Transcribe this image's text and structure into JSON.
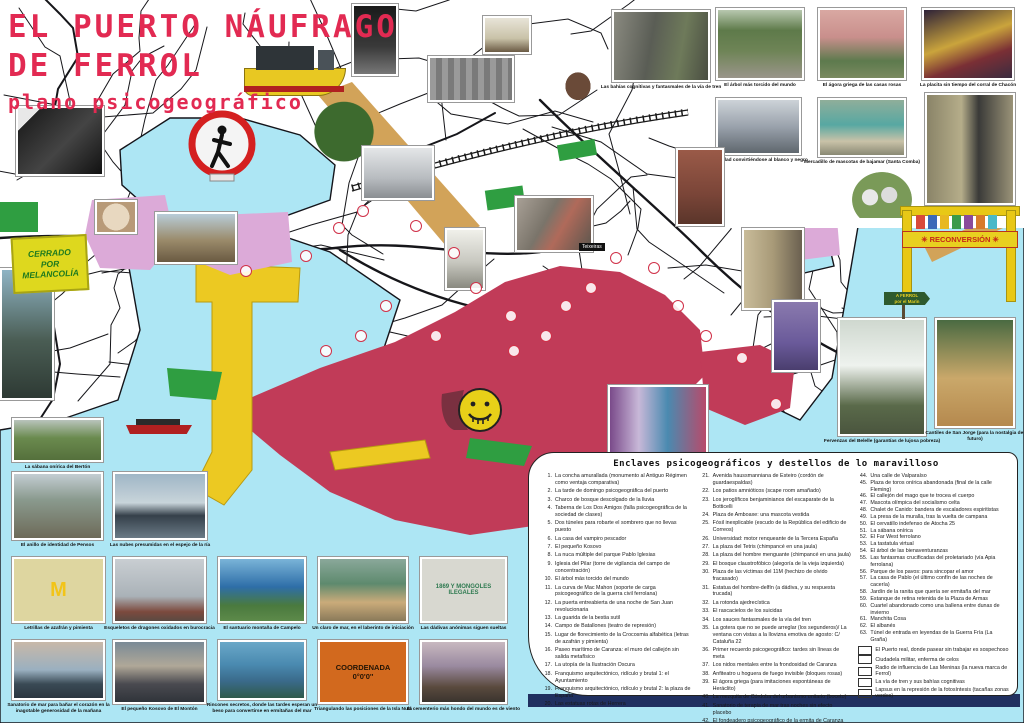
{
  "colors": {
    "water": "#ade6f4",
    "crimson": "#c13b58",
    "port_yellow": "#ecc922",
    "plum": "#dcaad8",
    "rail_tan": "#d2a359",
    "green": "#2f9e41",
    "annotation_red": "#e6254d",
    "title_red": "#e22a52",
    "navy_bar": "#203060"
  },
  "title": {
    "line1": "EL PUERTO NÁUFRAGO",
    "line2": "DE FERROL",
    "subtitle": "plano psicogeográfico"
  },
  "legend": {
    "title": "Enclaves psicogeográficos y destellos de lo maravilloso",
    "col1": [
      {
        "n": "1.",
        "t": "La concha amurallada (monumento al Antiguo Régimen como ventaja comparativa)"
      },
      {
        "n": "2.",
        "t": "La tarde de domingo psicogeográfica del puerto"
      },
      {
        "n": "3.",
        "t": "Charco de bosque descolgado de la lluvia"
      },
      {
        "n": "4.",
        "t": "Taberna de Los Dos Amigos (falla psicogeográfica de la sociedad de clases)"
      },
      {
        "n": "5.",
        "t": "Dos túneles para robarte el sombrero que no llevas puesto"
      },
      {
        "n": "6.",
        "t": "La casa del vampiro pescador"
      },
      {
        "n": "7.",
        "t": "El pequeño Kosovo"
      },
      {
        "n": "8.",
        "t": "La nuca múltiple del parque Pablo Iglesias"
      },
      {
        "n": "9.",
        "t": "Iglesia del Pilar (torre de vigilancia del campo de concentración)"
      },
      {
        "n": "10.",
        "t": "El árbol más torcido del mundo"
      },
      {
        "n": "11.",
        "t": "La curva de Mac Mahon (soporte de carga psicogeográfico de la guerra civil ferrolana)"
      },
      {
        "n": "12.",
        "t": "La puerta entreabierta de una noche de San Juan revolucionaria"
      },
      {
        "n": "13.",
        "t": "La guarida de la bestia sutil"
      },
      {
        "n": "14.",
        "t": "Campo de Batallones (teatro de represión)"
      },
      {
        "n": "15.",
        "t": "Lugar de florecimiento de la Crocosmia alfabética (letras de azafrán y pimienta)"
      },
      {
        "n": "16.",
        "t": "Paseo marítimo de Caranza: el muro del callejón sin salida metafísico"
      },
      {
        "n": "17.",
        "t": "La utopía de la Ilustración Oscura"
      },
      {
        "n": "18.",
        "t": "Franquismo arquitectónico, ridículo y brutal 1: el Ayuntamiento"
      },
      {
        "n": "19.",
        "t": "Franquismo arquitectónico, ridículo y brutal 2: la plaza de España"
      },
      {
        "n": "20.",
        "t": "Las estatuas rotas de Herrera"
      }
    ],
    "col2": [
      {
        "n": "21.",
        "t": "Avenida haussmanniana de Esteiro (cordón de guardaespaldas)"
      },
      {
        "n": "22.",
        "t": "Los patios amnióticos (scape room amañado)"
      },
      {
        "n": "23.",
        "t": "Los jeroglíficos benjaminianos del escaparate de la Botticelli"
      },
      {
        "n": "24.",
        "t": "Plaza de Amboaxe: una mascota vestida"
      },
      {
        "n": "25.",
        "t": "Fósil inexplicable (escudo de la República del edificio de Correos)"
      },
      {
        "n": "26.",
        "t": "Universidad: motor renqueante de la Tercera España"
      },
      {
        "n": "27.",
        "t": "La plaza del Tetris (chimpancé en una jaula)"
      },
      {
        "n": "28.",
        "t": "La plaza del hombre menguante (chimpancé en una jaula)"
      },
      {
        "n": "29.",
        "t": "El bosque claustrofóbico (alegoría de la vieja izquierda)"
      },
      {
        "n": "30.",
        "t": "Plaza de las víctimas del 11M (hechizo de olvido fracasado)"
      },
      {
        "n": "31.",
        "t": "Estatua del hombre-delfín (a dádiva, y su respuesta trucada)"
      },
      {
        "n": "32.",
        "t": "La rotonda ajedrecística"
      },
      {
        "n": "33.",
        "t": "El rascacielos de los suicidas"
      },
      {
        "n": "34.",
        "t": "Los sauces fantasmales de la vía del tren"
      },
      {
        "n": "35.",
        "t": "La gotera que no se puede arreglar (los segunderos)/ La ventana con vistas a la llovizna emotiva de agosto: C/ Cataluña 22"
      },
      {
        "n": "36.",
        "t": "Primer recuerdo psicogeográfico: tardes sin líneas de meta"
      },
      {
        "n": "37.",
        "t": "Los nidos mentales entre la frondosidad de Caranza"
      },
      {
        "n": "38.",
        "t": "Anfiteatro u hoguera de fuego invisible (bloques rosas)"
      },
      {
        "n": "39.",
        "t": "El ágora griega (para imitaciones espontáneas de Heráclito)"
      },
      {
        "n": "40.",
        "t": "La mezquita de Córdoba del urbanismo unitario (boceto)"
      },
      {
        "n": "41.",
        "t": "Sanatorio de terapia de mar tras noches sin efecto placebo"
      },
      {
        "n": "42.",
        "t": "El fondeadero psicogeográfico de la ermita de Caranza"
      },
      {
        "n": "43.",
        "t": "Edificios abstinentes importados de Argel"
      }
    ],
    "col3": [
      {
        "n": "44.",
        "t": "Una calle de Valparaíso"
      },
      {
        "n": "45.",
        "t": "Plaza de toros onírica abandonada (final de la calle Fleming)"
      },
      {
        "n": "46.",
        "t": "El callejón del mago que te trocea el cuerpo"
      },
      {
        "n": "47.",
        "t": "Mascota olímpica del socialismo celta"
      },
      {
        "n": "48.",
        "t": "Chalet de Canido: bandera de escaladores espiritistas"
      },
      {
        "n": "49.",
        "t": "La presa de la muralla, tras la vuelta de campana"
      },
      {
        "n": "50.",
        "t": "El cervatillo indefenso de Atocha 25"
      },
      {
        "n": "51.",
        "t": "La sábana onírica"
      },
      {
        "n": "52.",
        "t": "El Far West ferrolano"
      },
      {
        "n": "53.",
        "t": "La tastatula virtual"
      },
      {
        "n": "54.",
        "t": "El árbol de las bienaventuranzas"
      },
      {
        "n": "55.",
        "t": "Las fantasmas crucificadas del proletariado (vía Apia ferrolana)"
      },
      {
        "n": "56.",
        "t": "Parque de los pavos: para sincopar el amor"
      },
      {
        "n": "57.",
        "t": "La casa de Pablo (el último confín de las noches de cacería)"
      },
      {
        "n": "58.",
        "t": "Jardín de la ranita que quería ser ermitaña del mar"
      },
      {
        "n": "59.",
        "t": "Estanque de retina retenida de la Plaza de Armas"
      },
      {
        "n": "60.",
        "t": "Cuartel abandonado como una ballena entre dunas de invierno"
      },
      {
        "n": "61.",
        "t": "Manchita Cosa"
      },
      {
        "n": "62.",
        "t": "El albanés"
      },
      {
        "n": "63.",
        "t": "Túnel de entrada en leyendas de la Guerra Fría (La Graña)"
      }
    ],
    "swatches": [
      {
        "color": "#ecc922",
        "label": "El Puerto real, donde pasear sin trabajar es sospechoso"
      },
      {
        "color": "#c13b58",
        "label": "Ciudadela militar, enferma de celos"
      },
      {
        "color": "#dcaad8",
        "label": "Radio de influencia de Las Meninas (la nueva marca de Ferrol)"
      },
      {
        "color": "#d2a359",
        "label": "La vía de tren y sus bahías cognitivas"
      },
      {
        "color": "#2f9e41",
        "label": "Lapsus en la represión de la fotosíntesis (tacañas zonas verdes)"
      }
    ]
  },
  "annotations": [
    {
      "t": "Hacia un mundo rural que nunca llega a serlo (la ciudad porosa)",
      "x": 262,
      "y": 116,
      "rot": -19,
      "fs": 9.5,
      "c": "#e6254d"
    },
    {
      "t": "El patio trasero de la Maláta",
      "x": 176,
      "y": 130,
      "rot": -13,
      "fs": 10,
      "c": "#e6254d"
    },
    {
      "t": "El gueto enxebre de Catabois",
      "x": 500,
      "y": 44,
      "rot": -22,
      "fs": 11,
      "c": "#e6254d"
    },
    {
      "t": "El mal país del ensanche",
      "x": 447,
      "y": 174,
      "rot": -34,
      "fs": 10,
      "c": "#e6254d"
    },
    {
      "t": "La nueva patria sin épica de Ultramar",
      "x": 516,
      "y": 200,
      "rot": -38,
      "fs": 9.5,
      "c": "#e6254d"
    },
    {
      "t": "El Bertón (hemofilia\ninmobiliaria)",
      "x": 598,
      "y": 200,
      "rot": -14,
      "fs": 10,
      "c": "#e6254d"
    },
    {
      "t": "Caranza: isla paradisíaca:\nrepública pirata de Nassau",
      "x": 660,
      "y": 278,
      "rot": -10,
      "fs": 10.5,
      "c": "#e6254d"
    },
    {
      "t": "El Ohio psicogeográfico de Esteiro",
      "x": 408,
      "y": 266,
      "rot": 36,
      "fs": 10,
      "c": "#e6254d"
    },
    {
      "t": "La trama urbanística de la Magdalena",
      "x": 220,
      "y": 312,
      "rot": -18,
      "fs": 9,
      "c": "#e6254d"
    },
    {
      "t": "El Monte\nMinúsculo\ndel Marín",
      "x": 832,
      "y": 288,
      "rot": 0,
      "fs": 6.5,
      "c": "#e6254d"
    },
    {
      "t": "Ecosistemas de ballenas con zanjas",
      "x": 430,
      "y": 96,
      "rot": 0,
      "fs": 6.5,
      "c": "#e6254d"
    },
    {
      "t": "Cornucopias de huertas",
      "x": 548,
      "y": 214,
      "rot": -6,
      "fs": 6,
      "c": "#e6254d"
    },
    {
      "t": "El bajío de juguete\nde Ferrol Viejo",
      "x": 210,
      "y": 360,
      "rot": -38,
      "fs": 6.5,
      "c": "#e6254d"
    },
    {
      "t": "Pantanos efímeros",
      "x": 750,
      "y": 226,
      "rot": -8,
      "fs": 8.5,
      "c": "#222222"
    },
    {
      "t": "El cabo de Buena Esperanza",
      "x": 662,
      "y": 428,
      "rot": 0,
      "fs": 8,
      "c": "#111111"
    },
    {
      "t": "Red de calas clandestinas",
      "x": 642,
      "y": 304,
      "rot": 64,
      "fs": 7.5,
      "c": "#222222"
    },
    {
      "t": "El puerto que\nno es una postal",
      "x": 62,
      "y": 298,
      "rot": 0,
      "fs": 14.5,
      "c": "#111111",
      "lh": 1.35
    },
    {
      "t": "la ciudad militar\nemparedada",
      "x": 287,
      "y": 430,
      "rot": -12,
      "fs": 26,
      "c": "#111111",
      "ls": 2,
      "lh": 1.12,
      "ta": "center"
    },
    {
      "t": "FERROL\nMOLA",
      "x": 442,
      "y": 364,
      "rot": -8,
      "fs": 9,
      "c": "#e0bd14"
    }
  ],
  "markers": [
    {
      "n": "3",
      "x": 333,
      "y": 222
    },
    {
      "n": "30",
      "x": 357,
      "y": 205
    },
    {
      "n": "24",
      "x": 410,
      "y": 220
    },
    {
      "n": "4",
      "x": 448,
      "y": 247
    },
    {
      "n": "9",
      "x": 470,
      "y": 282
    },
    {
      "n": "27",
      "x": 505,
      "y": 310
    },
    {
      "n": "13",
      "x": 540,
      "y": 330
    },
    {
      "n": "26",
      "x": 560,
      "y": 300
    },
    {
      "n": "51",
      "x": 585,
      "y": 282
    },
    {
      "n": "33",
      "x": 610,
      "y": 252
    },
    {
      "n": "41",
      "x": 648,
      "y": 262
    },
    {
      "n": "37",
      "x": 672,
      "y": 300
    },
    {
      "n": "16",
      "x": 700,
      "y": 330
    },
    {
      "n": "42",
      "x": 736,
      "y": 352
    },
    {
      "n": "12",
      "x": 508,
      "y": 345
    },
    {
      "n": "18",
      "x": 430,
      "y": 330
    },
    {
      "n": "19",
      "x": 380,
      "y": 300
    },
    {
      "n": "21",
      "x": 355,
      "y": 330
    },
    {
      "n": "1",
      "x": 320,
      "y": 345
    },
    {
      "n": "58",
      "x": 770,
      "y": 398
    },
    {
      "n": "8",
      "x": 300,
      "y": 250
    },
    {
      "n": "45",
      "x": 240,
      "y": 265
    }
  ],
  "photos": [
    {
      "cap": "El árbol más torcido del mundo",
      "x": 716,
      "y": 8,
      "w": 88,
      "h": 72,
      "bg": "linear-gradient(180deg,#b8c8b0 0%,#5e7a4a 30%,#6e8456 60%,#9a958a 100%)"
    },
    {
      "cap": "El ágora griega de las casas rosas",
      "x": 818,
      "y": 8,
      "w": 88,
      "h": 72,
      "bg": "linear-gradient(180deg,#d9a8a2,#c98f8c 40%,#5d7a4d 75%,#7a8a60)"
    },
    {
      "cap": "La placita sin tiempo del corral de Chacón",
      "x": 922,
      "y": 8,
      "w": 92,
      "h": 72,
      "bg": "linear-gradient(160deg,#2e2238,#caa43c 45%,#7a2f35 70%,#3a2c40)"
    },
    {
      "cap": "La ciudad convirtiéndose al blanco y negro",
      "x": 716,
      "y": 98,
      "w": 85,
      "h": 57,
      "bg": "linear-gradient(180deg,#cdd3d8,#9aa2ac 50%,#5f676e)"
    },
    {
      "cap": "Mercadillo de mascotas de bajamar (Santa Comba)",
      "x": 818,
      "y": 98,
      "w": 88,
      "h": 59,
      "bg": "linear-gradient(180deg,#8fae9a,#57a8a2 45%,#c9c2a8 75%,#8a8a74)"
    },
    {
      "cap": "Los desfiladeros de Caranza",
      "x": 925,
      "y": 93,
      "w": 90,
      "h": 112,
      "bg": "linear-gradient(90deg,#8a8468,#b5ad8a 40%,#3a3a38 60%,#9a9378)"
    },
    {
      "cap": "Las bahías cognitivas y fantasmales de la vía de tren",
      "x": 612,
      "y": 10,
      "w": 98,
      "h": 72,
      "bg": "linear-gradient(100deg,#8a8a80,#5a5d55 40%,#6e7a5a 70%,#4a4e42)"
    },
    {
      "cap": "Fervenzas del Belelle (garantías de lujosa pobreza)",
      "x": 838,
      "y": 318,
      "w": 88,
      "h": 118,
      "bg": "linear-gradient(180deg,#cfd8cf,#eef2ee 40%,#5a6a4a 75%,#4a553e)"
    },
    {
      "cap": "Cantiles de San Jorge (para la nostalgia del futuro)",
      "x": 935,
      "y": 318,
      "w": 80,
      "h": 110,
      "bg": "linear-gradient(180deg,#4a6a42,#caa86a 55%,#b5894e)"
    },
    {
      "cap": "La sábana onírica del Bertón",
      "x": 12,
      "y": 418,
      "w": 91,
      "h": 44,
      "bg": "linear-gradient(180deg,#b9c4bc,#6a8a4e 45%,#55703c)"
    },
    {
      "cap": "El anillo de identidad de Pensos",
      "x": 12,
      "y": 472,
      "w": 91,
      "h": 68,
      "bg": "linear-gradient(180deg,#c3cdd2,#8a9a8e 40%,#6d6a58)"
    },
    {
      "cap": "Las nubes presumidas en el espejo de la ría",
      "x": 113,
      "y": 472,
      "w": 94,
      "h": 68,
      "bg": "linear-gradient(180deg,#9fb6c6,#c8d4da 45%,#35404a 65%,#6a7a86)"
    },
    {
      "cap": "Letrillas de azafrán y pimienta",
      "x": 12,
      "y": 557,
      "w": 93,
      "h": 66,
      "bg": "#ded6a0",
      "txt": "M",
      "txtc": "#f2c418",
      "txtfs": 20
    },
    {
      "cap": "Esqueletos de dragones oxidados en burocracia",
      "x": 113,
      "y": 557,
      "w": 93,
      "h": 66,
      "bg": "linear-gradient(180deg,#c9ced2,#aab2b8 60%,#7c4a3e 85%,#5a4a42)"
    },
    {
      "cap": "El santuario montaña de Campelo",
      "x": 218,
      "y": 557,
      "w": 88,
      "h": 66,
      "bg": "linear-gradient(180deg,#7ab4d8,#2e6ea8 45%,#4a7a3e 75%,#5d8a4a)"
    },
    {
      "cap": "Un claro de mar, en el laberinto de iniciación",
      "x": 318,
      "y": 557,
      "w": 90,
      "h": 66,
      "bg": "linear-gradient(180deg,#8aa89a,#5e8a6e 40%,#caab7a 70%,#8a7a5a)"
    },
    {
      "cap": "Las dádivas anónimas siguen sueltas",
      "x": 420,
      "y": 557,
      "w": 87,
      "h": 66,
      "bg": "#d8d8d0",
      "txt": "1869 Y MONGOLES\nILEGALES",
      "txtc": "#2e7a50",
      "txtfs": 6
    },
    {
      "cap": "Sanatorio de mar para bañar el corazón en la inagotable generosidad de la mañana",
      "x": 12,
      "y": 640,
      "w": 93,
      "h": 60,
      "bg": "linear-gradient(180deg,#c8b8a8,#9ab0c0 50%,#3a4a55 75%,#2a3640)"
    },
    {
      "cap": "El pequeño Kosovo de El Montón",
      "x": 113,
      "y": 640,
      "w": 93,
      "h": 64,
      "bg": "linear-gradient(180deg,#7a8a96,#b0a898 40%,#4a4a50 70%,#30343a)"
    },
    {
      "cap": "Rincones secretos, donde las tardes esperan un beso para convertirse en ermitañas del mar",
      "x": 218,
      "y": 640,
      "w": 88,
      "h": 60,
      "bg": "linear-gradient(180deg,#6aa8c8,#4a8ab0 40%,#3a6a8a 70%,#2e5a4a)"
    },
    {
      "cap": "Triangulando las posiciones de la Isla Nula",
      "x": 318,
      "y": 640,
      "w": 90,
      "h": 64,
      "bg": "#d2691e",
      "txt": "COORDENADA\n0°0'0''",
      "txtc": "#241505",
      "txtfs": 7.5
    },
    {
      "cap": "El cementerio más hondo del mundo es de viento",
      "x": 420,
      "y": 640,
      "w": 87,
      "h": 64,
      "bg": "linear-gradient(180deg,#c8b8c0,#9a8aa0 40%,#5a4a3e 75%,#3a342e)"
    },
    {
      "x": 0,
      "y": 268,
      "w": 54,
      "h": 132,
      "bg": "linear-gradient(180deg,#8fb4c4,#4a5d54 55%,#2e3a34)"
    },
    {
      "x": 16,
      "y": 106,
      "w": 88,
      "h": 70,
      "bg": "linear-gradient(135deg,#e8e8e8 15%,#222 15%,#444 55%,#111)"
    },
    {
      "x": 298,
      "y": 98,
      "w": 92,
      "h": 80,
      "cut": true,
      "bg": "radial-gradient(ellipse at 50% 42%,#3d6a2e 0 45%,rgba(0,0,0,0) 46%)"
    },
    {
      "x": 352,
      "y": 4,
      "w": 46,
      "h": 72,
      "bg": "linear-gradient(180deg,#1a1a1a,#3a3a3a 60%,#777)"
    },
    {
      "x": 428,
      "y": 56,
      "w": 86,
      "h": 46,
      "bg": "repeating-linear-gradient(90deg,#9a9a9a 0 6px,#7a7a7a 6px 12px)"
    },
    {
      "x": 483,
      "y": 16,
      "w": 48,
      "h": 38,
      "bg": "linear-gradient(180deg,#e8e4d8,#c9c2a8 60%,#6a5a44)"
    },
    {
      "x": 362,
      "y": 146,
      "w": 72,
      "h": 54,
      "bg": "linear-gradient(180deg,#e4e6e8,#b8bcc0 60%,#8a8e92)"
    },
    {
      "x": 445,
      "y": 228,
      "w": 40,
      "h": 62,
      "bg": "linear-gradient(180deg,#f0f0ea,#c8c8c0 55%,#8a8a80)"
    },
    {
      "x": 515,
      "y": 196,
      "w": 78,
      "h": 56,
      "bg": "linear-gradient(120deg,#a8a096,#7a746a 40%,#b06a5a 60%,#5a564e)"
    },
    {
      "x": 608,
      "y": 385,
      "w": 100,
      "h": 85,
      "bg": "linear-gradient(90deg,#7a4a8a,#c8b8d8 30%,#4a8ab0 60%,#b84a6a)"
    },
    {
      "x": 676,
      "y": 148,
      "w": 48,
      "h": 78,
      "bg": "linear-gradient(180deg,#9a5a48,#7a4538 60%,#5a352a)"
    },
    {
      "x": 742,
      "y": 228,
      "w": 62,
      "h": 82,
      "bg": "linear-gradient(90deg,#c9bc9a,#a89a78 50%,#6a6050)"
    },
    {
      "x": 772,
      "y": 300,
      "w": 48,
      "h": 72,
      "bg": "linear-gradient(180deg,#8a7aae,#6a5a9a 60%,#4a3e6e)"
    },
    {
      "x": 852,
      "y": 172,
      "w": 60,
      "h": 46,
      "cut": true,
      "bg": "radial-gradient(circle at 30% 55%,#e8e8e8 0 16%,rgba(0,0,0,0) 17%),radial-gradient(circle at 62% 50%,#dcdcdc 0 18%,rgba(0,0,0,0) 19%),radial-gradient(ellipse at 50% 60%,#7a9a58 0 70%,rgba(0,0,0,0) 71%)"
    },
    {
      "x": 556,
      "y": 62,
      "w": 44,
      "h": 44,
      "cut": true,
      "bg": "radial-gradient(ellipse at 50% 55%,#6a4a38 0 40%,rgba(0,0,0,0) 41%)"
    },
    {
      "x": 155,
      "y": 212,
      "w": 82,
      "h": 52,
      "bg": "linear-gradient(180deg,#b8ccd8,#9a8a6a 55%,#6a5a42)"
    },
    {
      "x": 95,
      "y": 200,
      "w": 42,
      "h": 34,
      "bg": "radial-gradient(circle at 50% 50%,#e8d8c0 0 55%,#b89a78 56%)"
    }
  ],
  "signs": {
    "cerrado": "CERRADO\nPOR\nMELANCOLÍA",
    "reconversion": "✳ RECONVERSIÓN ✳",
    "teixeiras": "Teixeiras",
    "signpost_l1": "A FERROL",
    "signpost_l2": "por el Marín"
  }
}
